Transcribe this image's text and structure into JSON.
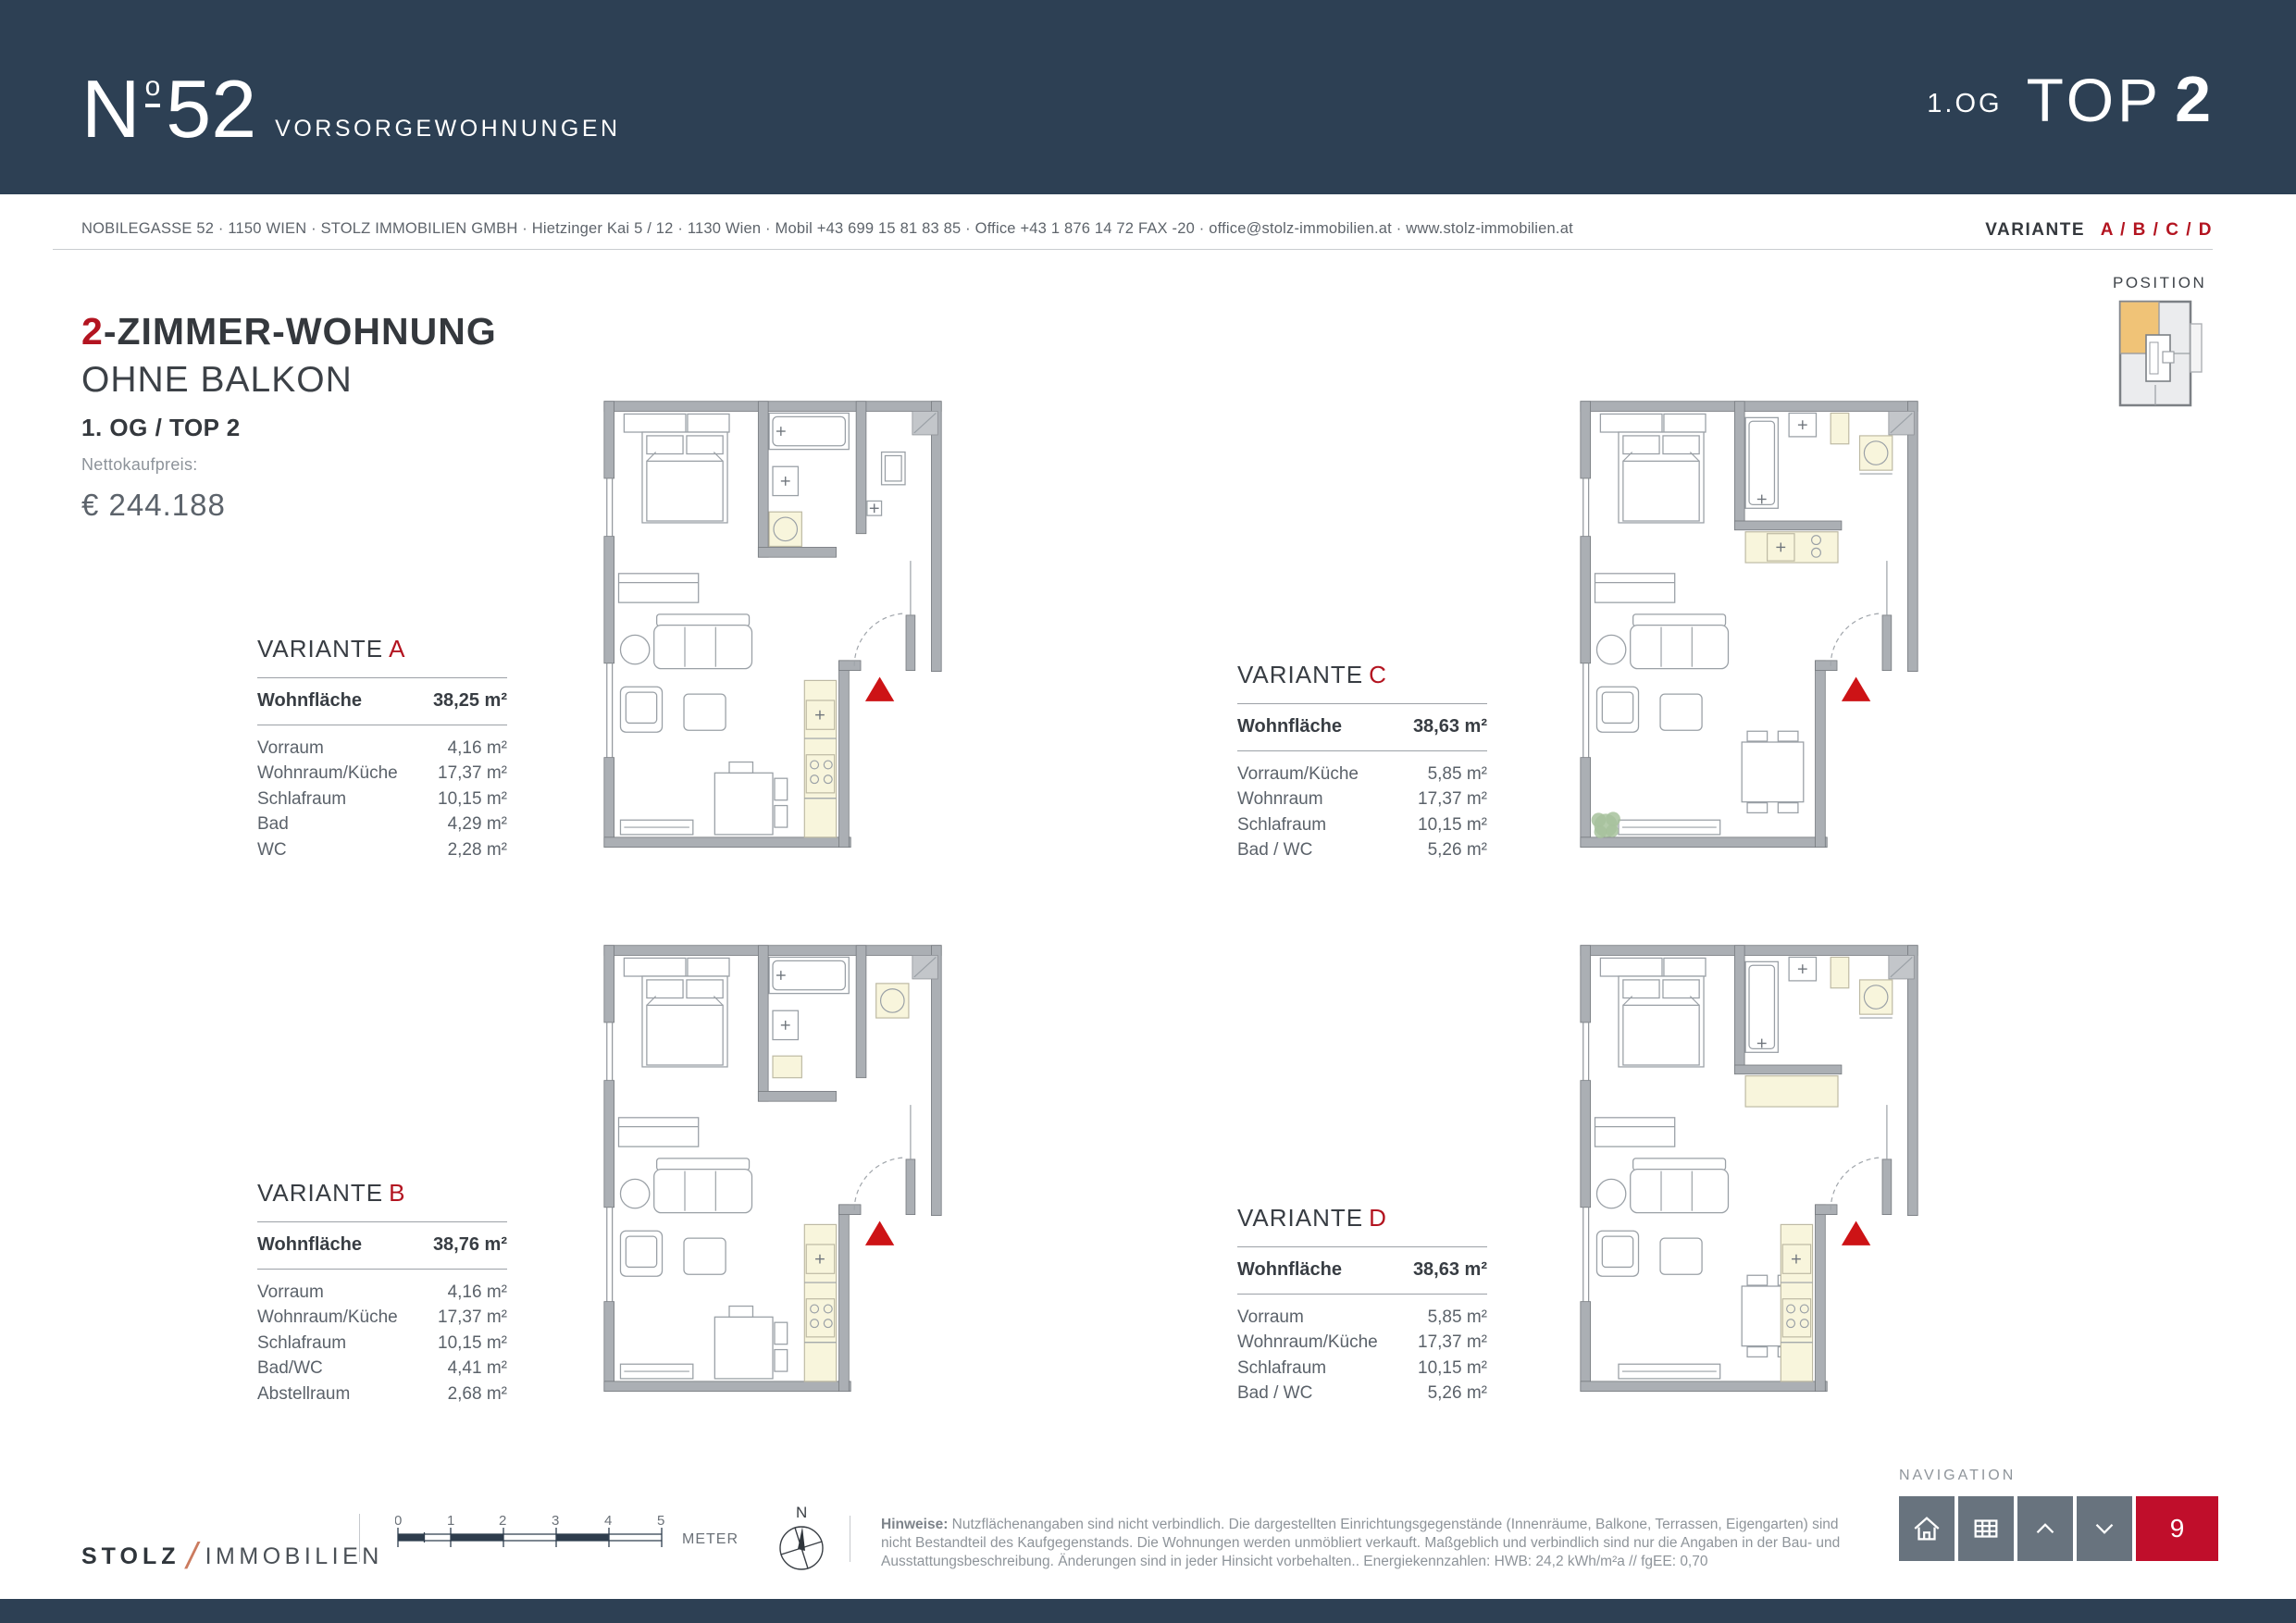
{
  "colors": {
    "navy": "#2d4054",
    "accent_red": "#b31420",
    "nav_red": "#c00e2b",
    "entrance_triangle_red": "#cd1316",
    "position_highlight_orange": "#f0c377",
    "brand_slash_orange": "#cb7b5f"
  },
  "header": {
    "logo_n": "N",
    "logo_deg": "o",
    "logo_num": "52",
    "brand": "VORSORGEWOHNUNGEN",
    "floor_small": "1.OG",
    "top_word": "TOP",
    "top_number": "2"
  },
  "infobar": {
    "address": "NOBILEGASSE 52 · 1150 WIEN · STOLZ IMMOBILIEN GMBH · Hietzinger Kai 5 / 12 · 1130 Wien · Mobil +43 699 15 81 83 85 · Office +43 1 876 14 72  FAX -20 · office@stolz-immobilien.at · www.stolz-immobilien.at",
    "variante_label": "VARIANTE",
    "variante_options": "A / B / C / D"
  },
  "position_widget": {
    "label": "POSITION"
  },
  "apartment": {
    "rooms_number": "2",
    "title_rest": "-ZIMMER-WOHNUNG",
    "subtitle": "OHNE BALKON",
    "floor_top": "1. OG / TOP 2",
    "price_label": "Nettokaufpreis:",
    "price_value": "€ 244.188"
  },
  "variants": [
    {
      "letter": "A",
      "label": "VARIANTE",
      "area_label": "Wohnfläche",
      "area_value": "38,25 m²",
      "rows": [
        {
          "label": "Vorraum",
          "value": "4,16 m²"
        },
        {
          "label": "Wohnraum/Küche",
          "value": "17,37 m²"
        },
        {
          "label": "Schlafraum",
          "value": "10,15 m²"
        },
        {
          "label": "Bad",
          "value": "4,29 m²"
        },
        {
          "label": "WC",
          "value": "2,28 m²"
        }
      ]
    },
    {
      "letter": "B",
      "label": "VARIANTE",
      "area_label": "Wohnfläche",
      "area_value": "38,76 m²",
      "rows": [
        {
          "label": "Vorraum",
          "value": "4,16 m²"
        },
        {
          "label": "Wohnraum/Küche",
          "value": "17,37 m²"
        },
        {
          "label": "Schlafraum",
          "value": "10,15 m²"
        },
        {
          "label": "Bad/WC",
          "value": "4,41 m²"
        },
        {
          "label": "Abstellraum",
          "value": "2,68 m²"
        }
      ]
    },
    {
      "letter": "C",
      "label": "VARIANTE",
      "area_label": "Wohnfläche",
      "area_value": "38,63 m²",
      "rows": [
        {
          "label": "Vorraum/Küche",
          "value": "5,85 m²"
        },
        {
          "label": "Wohnraum",
          "value": "17,37 m²"
        },
        {
          "label": "Schlafraum",
          "value": "10,15 m²"
        },
        {
          "label": "Bad / WC",
          "value": "5,26 m²"
        }
      ]
    },
    {
      "letter": "D",
      "label": "VARIANTE",
      "area_label": "Wohnfläche",
      "area_value": "38,63 m²",
      "rows": [
        {
          "label": "Vorraum",
          "value": "5,85 m²"
        },
        {
          "label": "Wohnraum/Küche",
          "value": "17,37 m²"
        },
        {
          "label": "Schlafraum",
          "value": "10,15 m²"
        },
        {
          "label": "Bad / WC",
          "value": "5,26 m²"
        }
      ]
    }
  ],
  "footer": {
    "brand_first": "STOLZ",
    "brand_slash": "/",
    "brand_second": "IMMOBILIEN",
    "scale_ticks": [
      "0",
      "1",
      "2",
      "3",
      "4",
      "5"
    ],
    "scale_unit": "METER",
    "compass_north": "N",
    "hinweise_label": "Hinweise:",
    "hinweise_text": "Nutzflächenangaben sind nicht verbindlich. Die dargestellten Einrichtungsgegenstände (Innenräume, Balkone, Terrassen, Eigengarten) sind nicht Bestandteil des Kaufgegenstands. Die Wohnungen werden unmöbliert verkauft. Maßgeblich und verbindlich sind nur die Angaben in der Bau- und Ausstattungsbeschreibung. Änderungen sind in jeder Hinsicht vorbehalten.. Energiekennzahlen: HWB:  24,2 kWh/m²a  //  fgEE:  0,70",
    "navigation_label": "NAVIGATION",
    "page_number": "9"
  }
}
